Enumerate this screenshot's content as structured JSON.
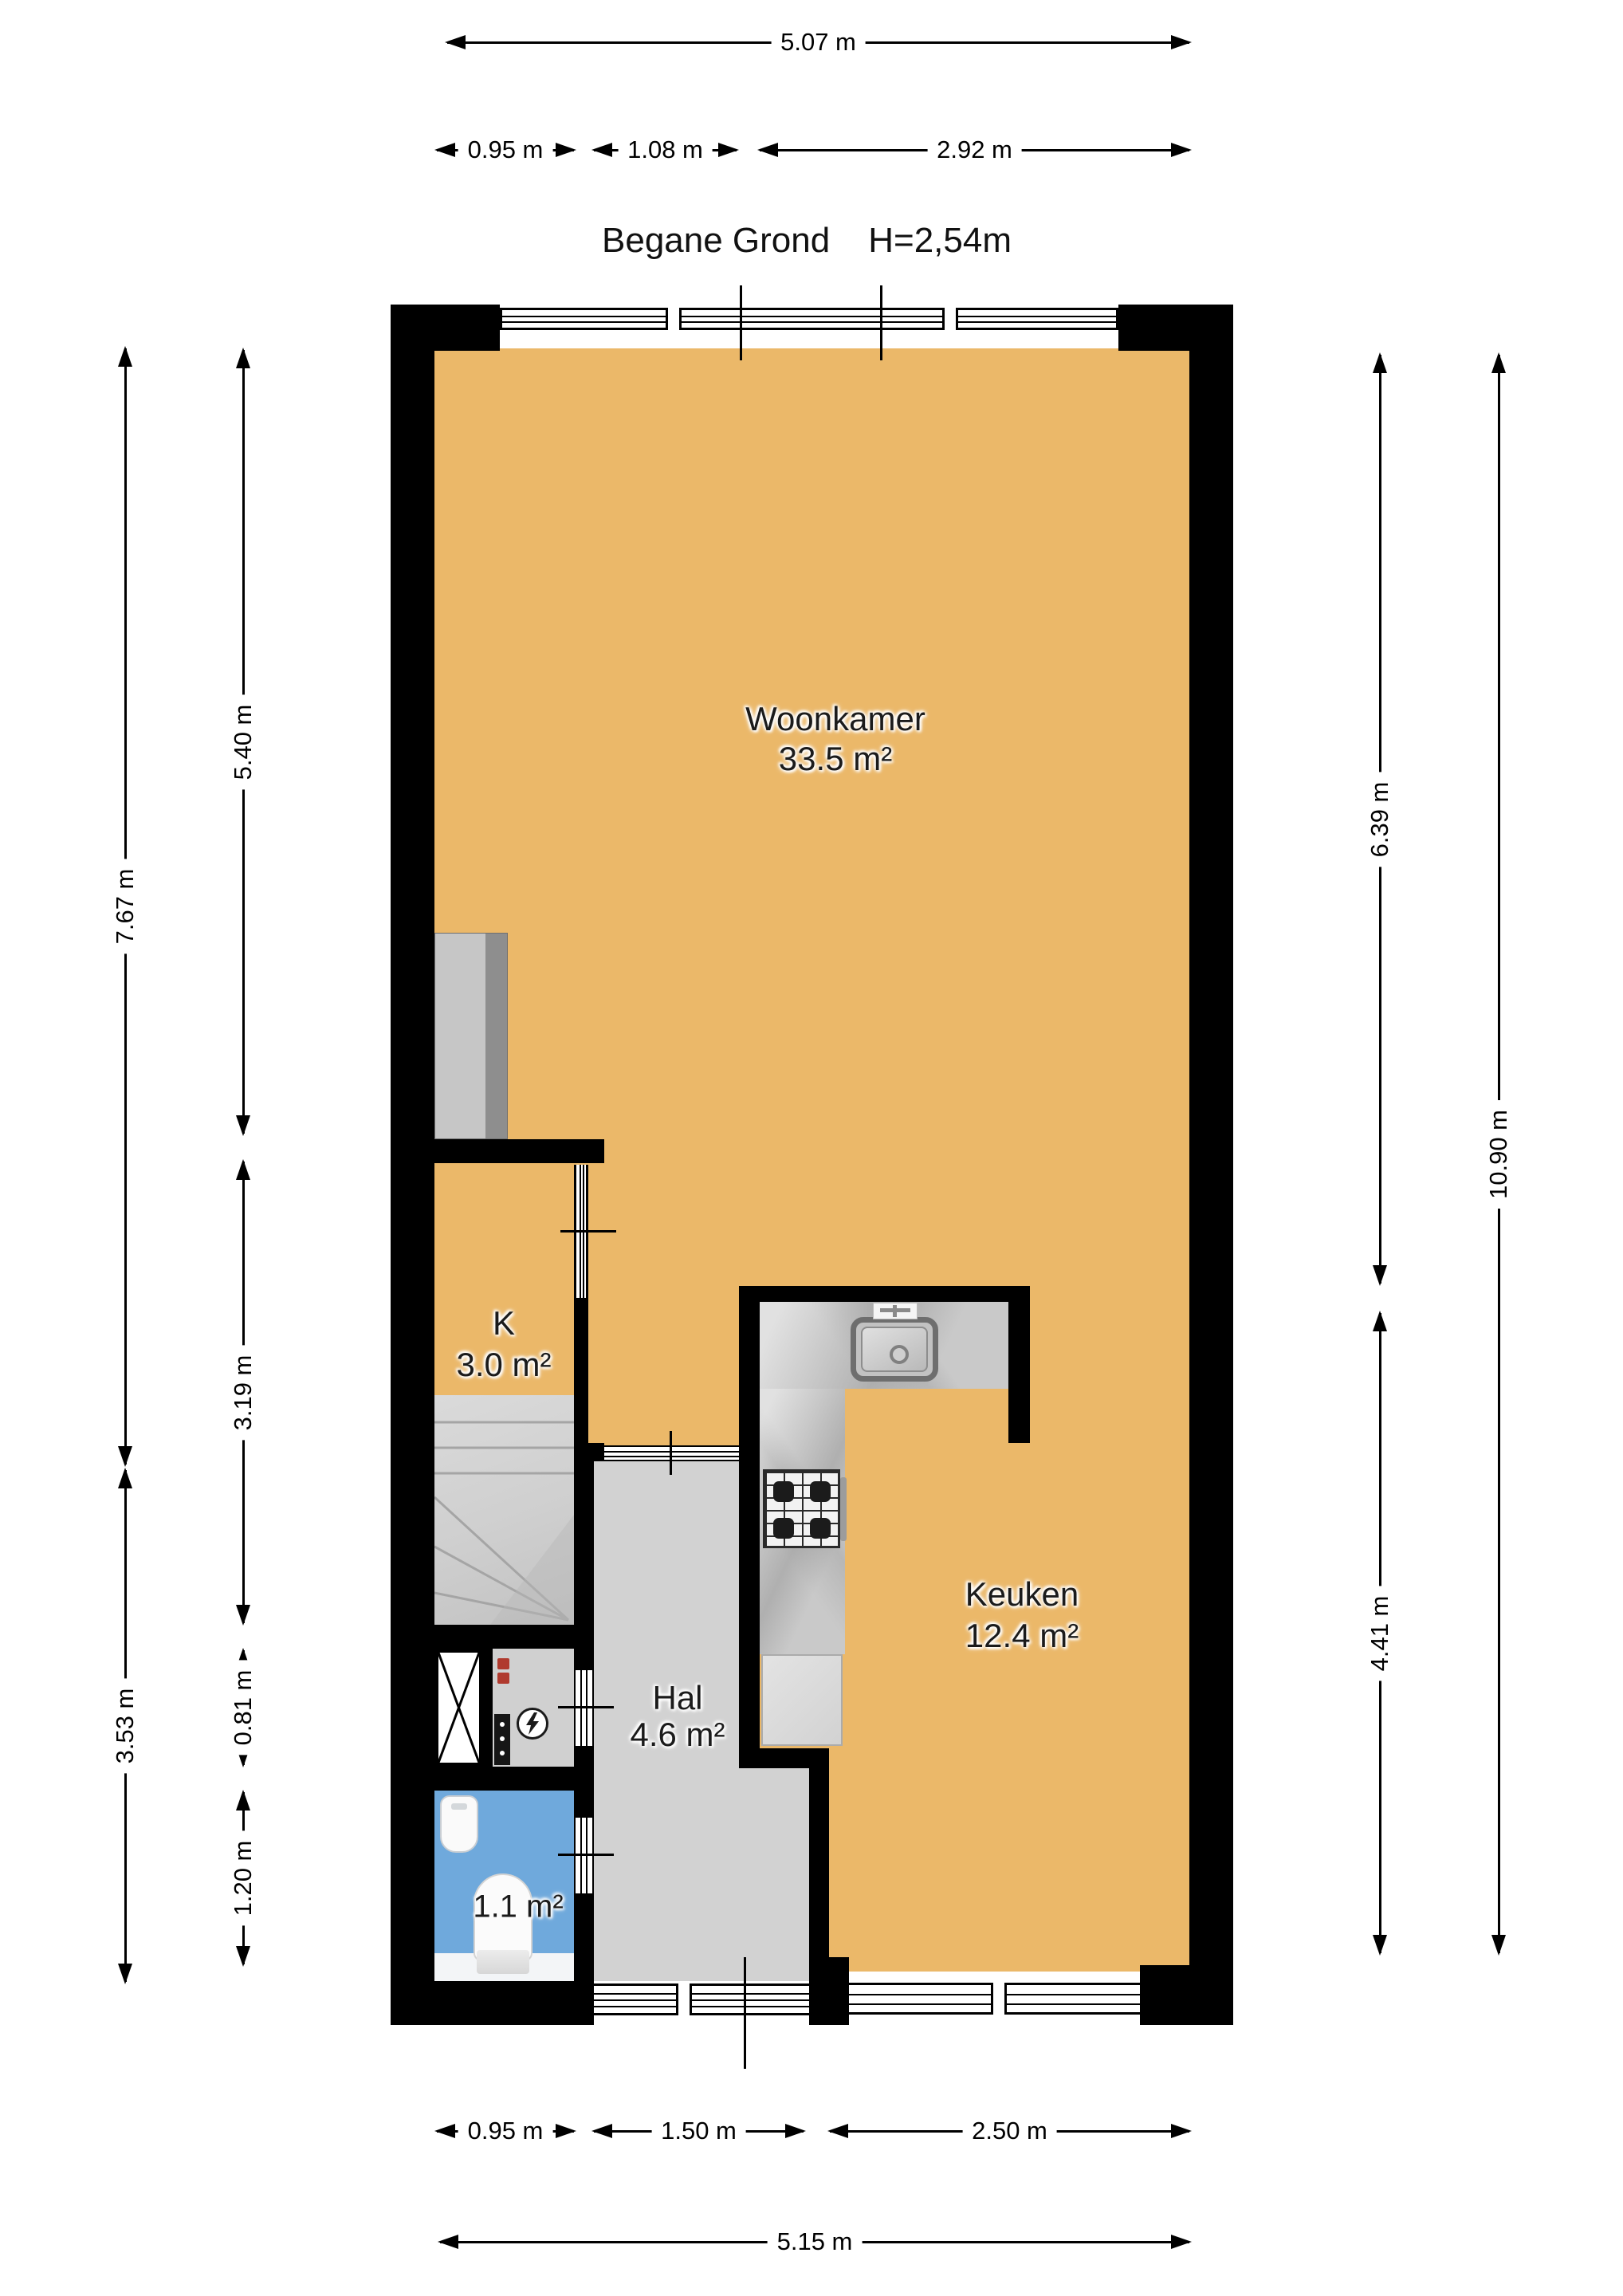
{
  "header": {
    "title": "Begane Grond",
    "ceiling_height": "H=2,54m"
  },
  "rooms": {
    "woonkamer": {
      "name": "Woonkamer",
      "area": "33.5 m²"
    },
    "kast": {
      "name": "K",
      "area": "3.0 m²"
    },
    "keuken": {
      "name": "Keuken",
      "area": "12.4 m²"
    },
    "hal": {
      "name": "Hal",
      "area": "4.6 m²"
    },
    "toilet": {
      "area": "1.1 m²"
    }
  },
  "dims": {
    "top_total": "5.07 m",
    "top_seg1": "0.95 m",
    "top_seg2": "1.08 m",
    "top_seg3": "2.92 m",
    "left_outer_upper": "7.67 m",
    "left_outer_lower": "3.53 m",
    "left_inner_1": "5.40 m",
    "left_inner_2": "3.19 m",
    "left_inner_3": "0.81 m",
    "left_inner_4": "1.20 m",
    "right_inner_upper": "6.39 m",
    "right_inner_lower": "4.41 m",
    "right_outer": "10.90 m",
    "bottom_seg1": "0.95 m",
    "bottom_seg2": "1.50 m",
    "bottom_seg3": "2.50 m",
    "bottom_total": "5.15 m"
  },
  "colors": {
    "wall": "#000000",
    "living_floor": "#EBB869",
    "hall_floor": "#D2D2D2",
    "toilet_floor": "#6FA9DC",
    "counter": "#C9C9C9"
  }
}
